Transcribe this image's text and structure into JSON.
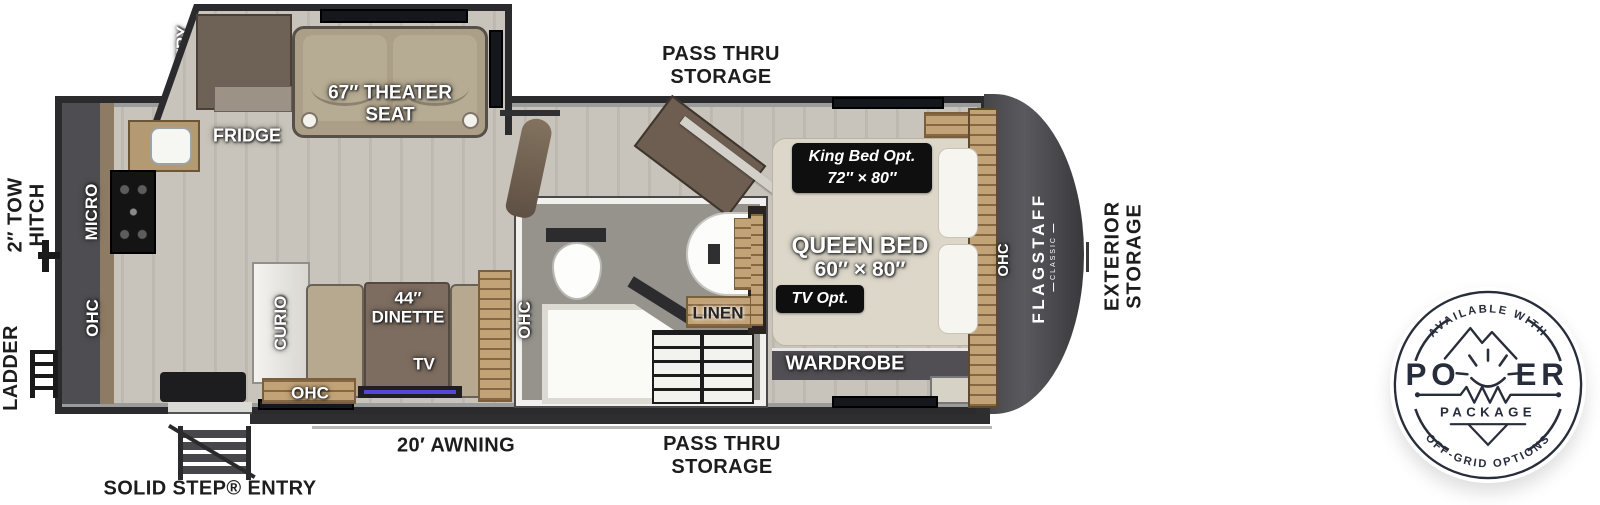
{
  "exterior": {
    "pass_thru_top": [
      "PASS THRU",
      "STORAGE"
    ],
    "pass_thru_bottom": [
      "PASS THRU",
      "STORAGE"
    ],
    "tow_hitch": [
      "2″ TOW",
      "HITCH"
    ],
    "ladder": "LADDER",
    "solid_step": "SOLID STEP® ENTRY",
    "awning": "20′ AWNING",
    "exterior_storage": [
      "EXTERIOR",
      "STORAGE"
    ]
  },
  "interior": {
    "pantry": "PANTRY",
    "fridge": "FRIDGE",
    "theater_seat": [
      "67″ THEATER",
      "SEAT"
    ],
    "micro": "MICRO",
    "ohc_kitchen": "OHC",
    "curio": "CURIO",
    "dinette": [
      "44″",
      "DINETTE"
    ],
    "tv": "TV",
    "ohc_dinette": "OHC",
    "ohc_bath": "OHC",
    "linen": "LINEN",
    "king_bed_option": [
      "King Bed Opt.",
      "72″ × 80″"
    ],
    "queen_bed": [
      "QUEEN BED",
      "60″ × 80″"
    ],
    "tv_option": "TV Opt.",
    "wardrobe": "WARDROBE",
    "ohc_bed": "OHC"
  },
  "brand": {
    "name": "FLAGSTAFF",
    "series": "CLASSIC"
  },
  "power_badge": {
    "top_arc": "AVAILABLE WITH",
    "title_left": "PO",
    "title_right": "ER",
    "subtitle": "PACKAGE",
    "bottom_arc": "OFF-GRID OPTIONS"
  },
  "colors": {
    "wall": "#2b2b2d",
    "floor": "#c4c0b7",
    "front_cap": "#4a4a4e",
    "cabinet_wood": "#c2a377",
    "option_badge_bg": "#0f0f10",
    "power_badge_navy": "#272d3a"
  }
}
